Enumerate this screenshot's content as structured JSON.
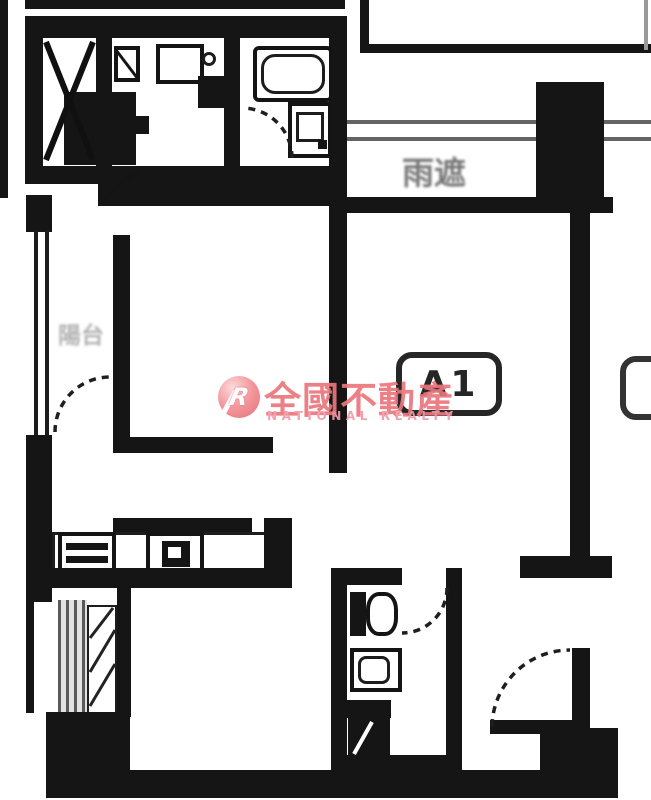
{
  "floorplan": {
    "unit_badge": "A1",
    "canopy_label": "雨遮",
    "balcony_label": "陽台"
  },
  "watermark": {
    "monogram": "R",
    "name_zh": "全國不動產",
    "name_en": "NATIONAL REALTY",
    "circle_color": "#ef8289",
    "text_color_zh": "#ea767c",
    "text_color_en": "#f09ba7"
  },
  "colors": {
    "wall": "#151515",
    "background": "#ffffff"
  }
}
